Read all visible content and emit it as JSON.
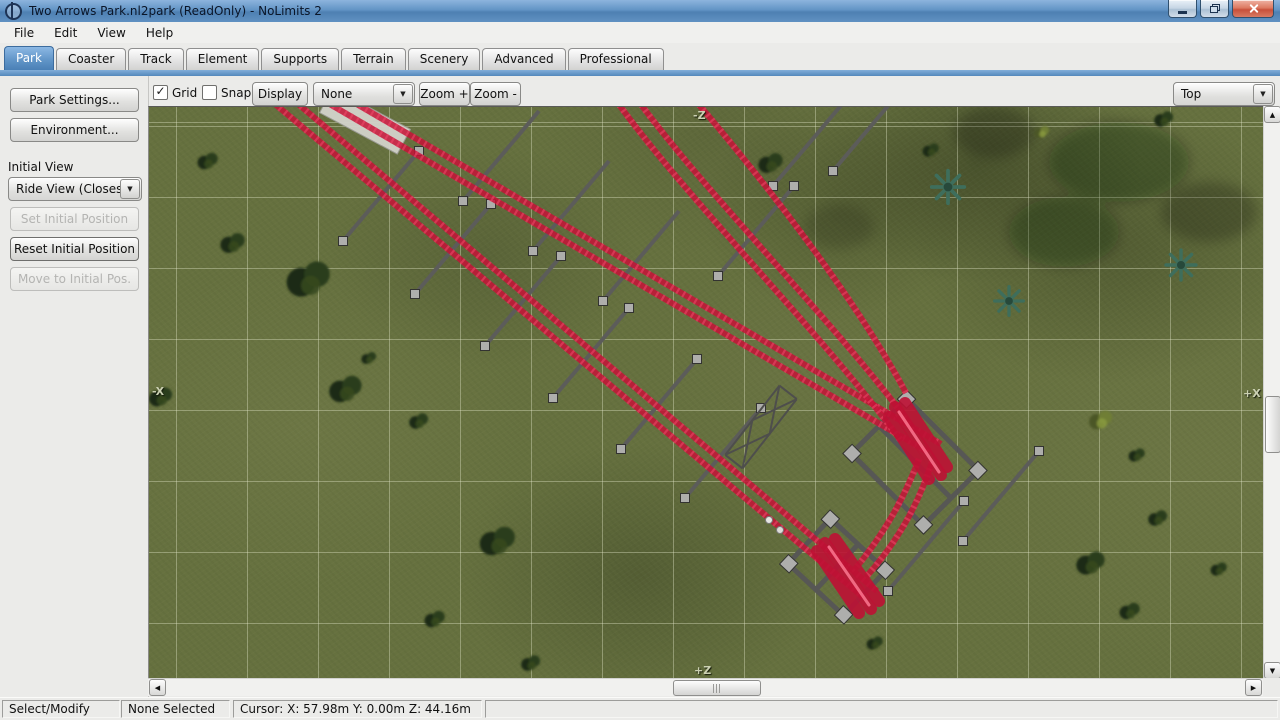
{
  "window": {
    "title": "Two Arrows Park.nl2park (ReadOnly) - NoLimits 2"
  },
  "menu": {
    "items": [
      "File",
      "Edit",
      "View",
      "Help"
    ]
  },
  "tabs": {
    "active": "Park",
    "items": [
      {
        "label": "Park"
      },
      {
        "label": "Coaster"
      },
      {
        "label": "Track"
      },
      {
        "label": "Element"
      },
      {
        "label": "Supports"
      },
      {
        "label": "Terrain"
      },
      {
        "label": "Scenery"
      },
      {
        "label": "Advanced"
      },
      {
        "label": "Professional"
      }
    ]
  },
  "toolbar": {
    "grid_label": "Grid",
    "grid_checked": true,
    "snap_label": "Snap",
    "snap_checked": false,
    "display_button": "Display",
    "mode_dropdown_value": "None",
    "zoom_in_button": "Zoom +",
    "zoom_out_button": "Zoom -",
    "view_dropdown_value": "Top"
  },
  "sidebar": {
    "park_settings_button": "Park Settings...",
    "environment_button": "Environment...",
    "initial_view_label": "Initial View",
    "initial_view_dropdown_value": "Ride View (Closest",
    "set_initial_position_button": "Set Initial Position",
    "reset_initial_position_button": "Reset Initial Position",
    "move_to_initial_pos_button": "Move to Initial Pos."
  },
  "viewport": {
    "axis_top": "-Z",
    "axis_bottom": "+Z",
    "axis_left": "-X",
    "axis_right": "+X"
  },
  "statusbar": {
    "mode": "Select/Modify",
    "selection": "None Selected",
    "cursor": "Cursor: X: 57.98m Y: 0.00m Z: 44.16m"
  },
  "icons": {
    "check": "✓",
    "arrow_down": "▼",
    "scroll_up": "▲",
    "scroll_down": "▼",
    "scroll_left": "◀",
    "scroll_right": "▶"
  },
  "colors": {
    "track_red": "#c51337",
    "support_gray": "#5c5c5a",
    "grass_green": "#66713f",
    "accent_blue": "#4d86bd"
  }
}
